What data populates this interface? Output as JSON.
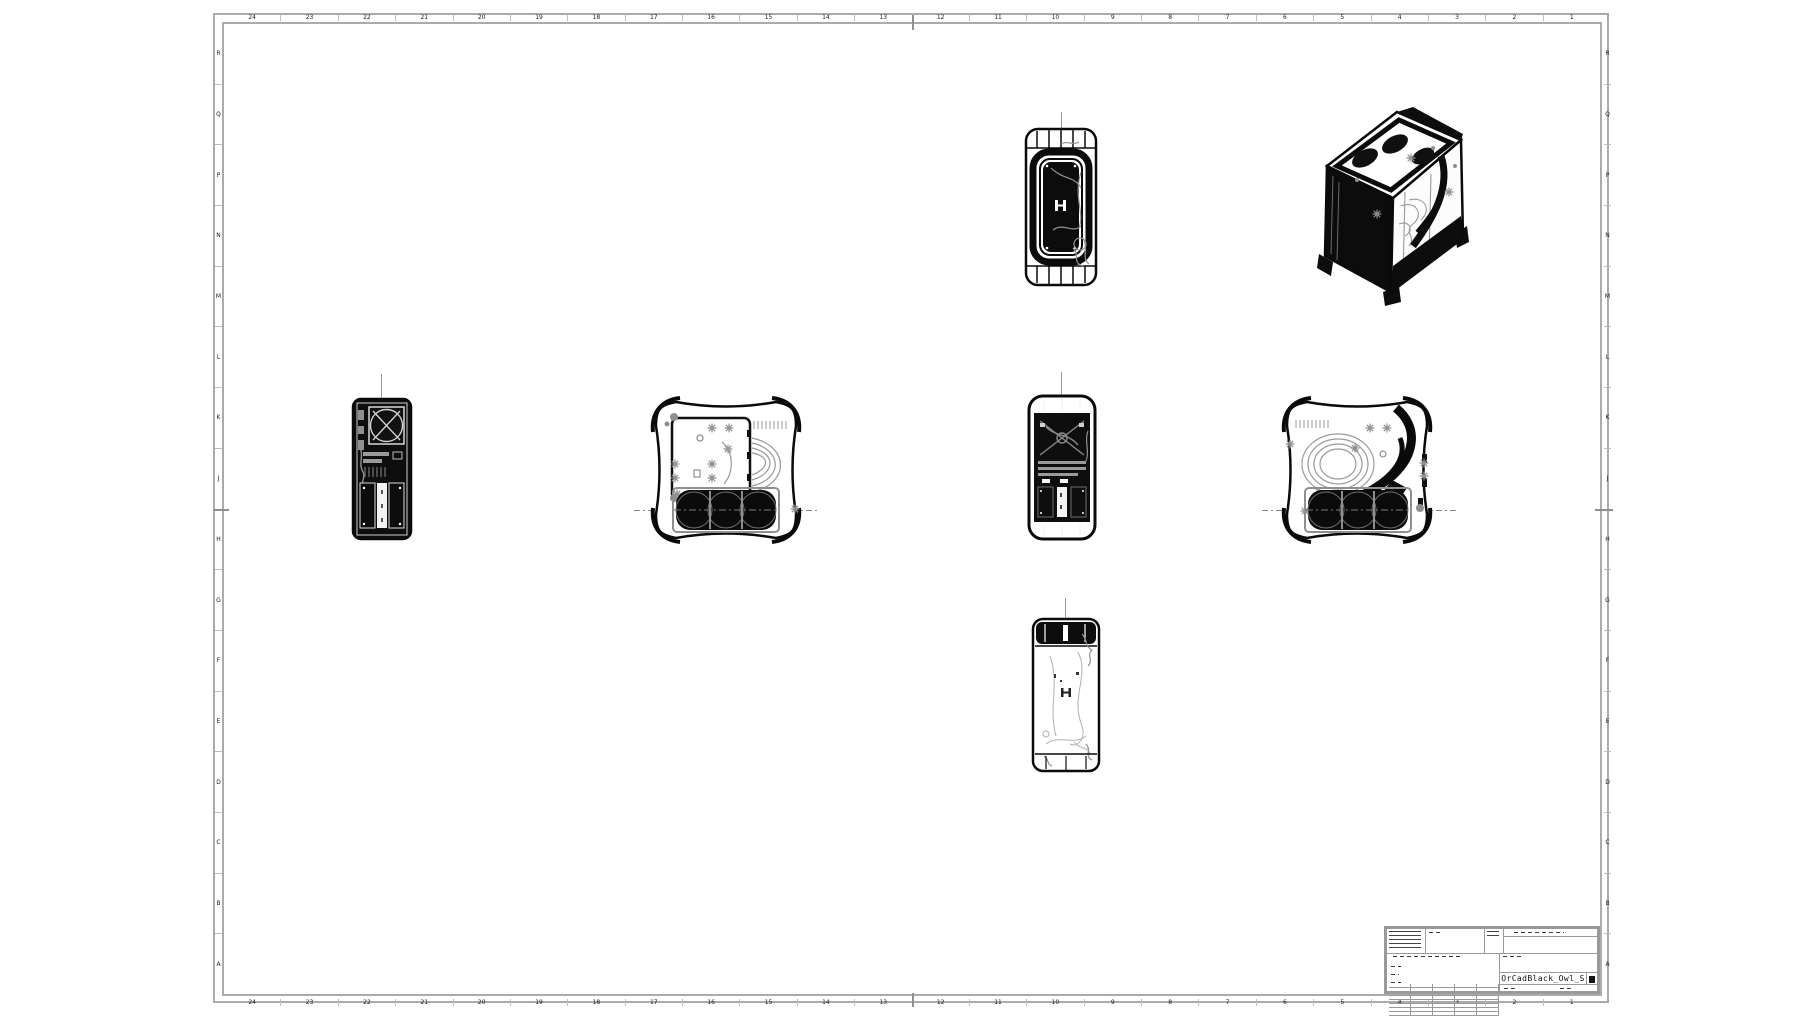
{
  "sheet": {
    "kind": "engineering-drawing-sheet",
    "zone_columns_left_to_right": [
      "24",
      "23",
      "22",
      "21",
      "20",
      "19",
      "18",
      "17",
      "16",
      "15",
      "14",
      "13",
      "12",
      "11",
      "10",
      "9",
      "8",
      "7",
      "6",
      "5",
      "4",
      "3",
      "2",
      "1"
    ],
    "zone_rows_top_to_bottom": [
      "R",
      "Q",
      "P",
      "N",
      "M",
      "L",
      "K",
      "J",
      "H",
      "G",
      "F",
      "E",
      "D",
      "C",
      "B",
      "A"
    ],
    "colors": {
      "background": "#ffffff",
      "frame_border": "#ababab",
      "drawing_line": "#0a0a0a",
      "drawing_detail": "#8f8f8f"
    }
  },
  "title_block": {
    "title": "OrCadBlack_Owl_S"
  }
}
